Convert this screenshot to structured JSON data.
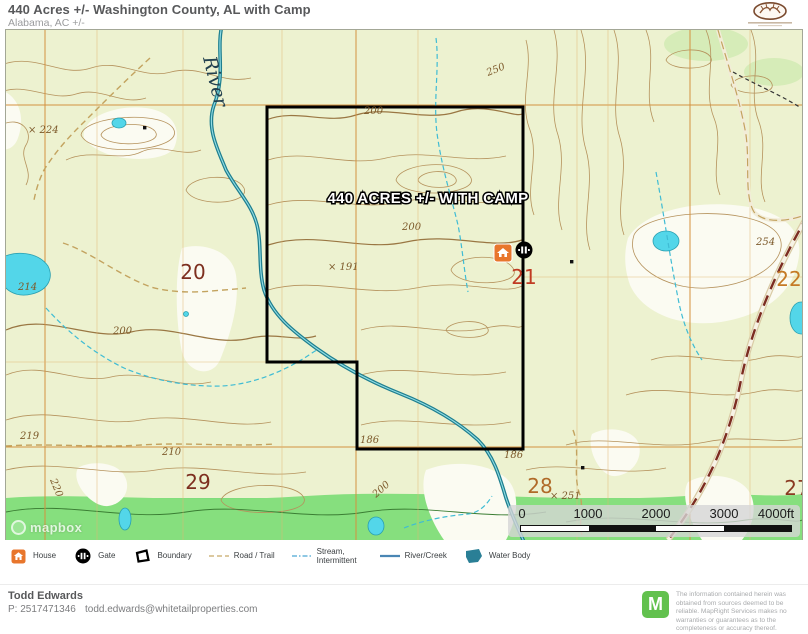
{
  "header": {
    "title": "440 Acres +/- Washington County, AL with Camp",
    "subtitle": "Alabama,  AC +/-"
  },
  "map": {
    "acreage_label": "440 ACRES +/- WITH CAMP",
    "river_label": "River",
    "attribution": "mapbox",
    "sections": [
      "20",
      "21",
      "22",
      "29",
      "28",
      "27"
    ],
    "section_colors": [
      "#7d2f1f",
      "#c03b23",
      "#c57a25",
      "#7d2f1f",
      "#b06a28",
      "#8a3a22"
    ],
    "contours": [
      "× 224",
      "214",
      "250",
      "200",
      "200",
      "200",
      "× 191",
      "186",
      "186",
      "210",
      "219",
      "220",
      "200",
      "254",
      "× 251"
    ],
    "scale": {
      "ticks": [
        "0",
        "1000",
        "2000",
        "3000",
        "4000ft"
      ]
    },
    "markers": [
      {
        "name": "house",
        "icon": "house-icon"
      },
      {
        "name": "gate",
        "icon": "gate-icon"
      }
    ],
    "colors": {
      "boundary": "#000000",
      "house_marker": "#e8762c",
      "water_fill": "#53d6e9",
      "river_line": "#1f7f8f",
      "section_grid": "#d4913f",
      "vegetation_band": "#7fdc7c",
      "contour_line": "#b5925c"
    }
  },
  "legend": {
    "items": [
      {
        "label": "House"
      },
      {
        "label": "Gate"
      },
      {
        "label": "Boundary"
      },
      {
        "label": "Road / Trail"
      },
      {
        "label": "Stream, Intermittent"
      },
      {
        "label": "River/Creek"
      },
      {
        "label": "Water Body"
      }
    ]
  },
  "footer": {
    "agent": "Todd Edwards",
    "phone": "P: 2517471346",
    "email": "todd.edwards@whitetailproperties.com",
    "brand_letter": "M",
    "disclaimer": "The information contained herein was obtained from sources deemed to be reliable.  MapRight Services makes no warranties or guarantees as to the completeness or accuracy thereof."
  }
}
